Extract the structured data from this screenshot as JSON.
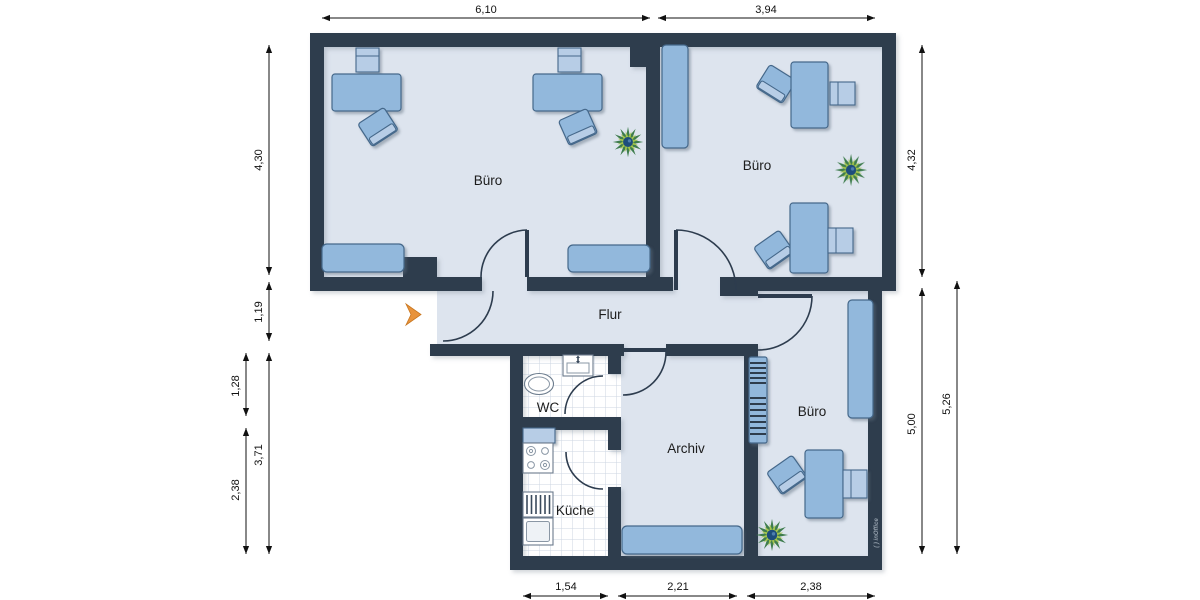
{
  "colors": {
    "wall": "#2d3c4e",
    "floor": "#dde4ee",
    "furniture": "#92b8dc",
    "furniture_light": "#b7cde6",
    "furniture_border": "#44678a",
    "tile_grid": "#ccd6e2",
    "dimension_text": "#111111",
    "entrance_arrow": "#e8933c",
    "plant_outer": "#3f7d4e",
    "plant_inner": "#a8c84c",
    "plant_center": "#1d4d7c",
    "watermark": "#95a1ad"
  },
  "rooms": {
    "buero_top_left": {
      "label": "Büro"
    },
    "buero_top_right": {
      "label": "Büro"
    },
    "flur": {
      "label": "Flur"
    },
    "wc": {
      "label": "WC"
    },
    "kueche": {
      "label": "Küche"
    },
    "archiv": {
      "label": "Archiv"
    },
    "buero_bottom_right": {
      "label": "Büro"
    }
  },
  "dimensions": {
    "top": [
      "6,10",
      "3,94"
    ],
    "left_inner": [
      "4,30",
      "1,19",
      "3,71"
    ],
    "left_outer": [
      "1,28",
      "2,38"
    ],
    "right_inner": [
      "4,32",
      "5,00"
    ],
    "right_outer": [
      "5,26"
    ],
    "bottom": [
      "1,54",
      "2,21",
      "2,38"
    ]
  },
  "watermark": {
    "text": "( ) inOffice"
  },
  "icons": {
    "entrance_arrow": "orange right-chevron",
    "plant": "green star plant, top view",
    "toilet": "toilet with cistern, top view",
    "sink": "oval washbasin, top view",
    "stove": "four-burner stove, top view",
    "kitchen_sink": "sink unit with drainer lines"
  }
}
